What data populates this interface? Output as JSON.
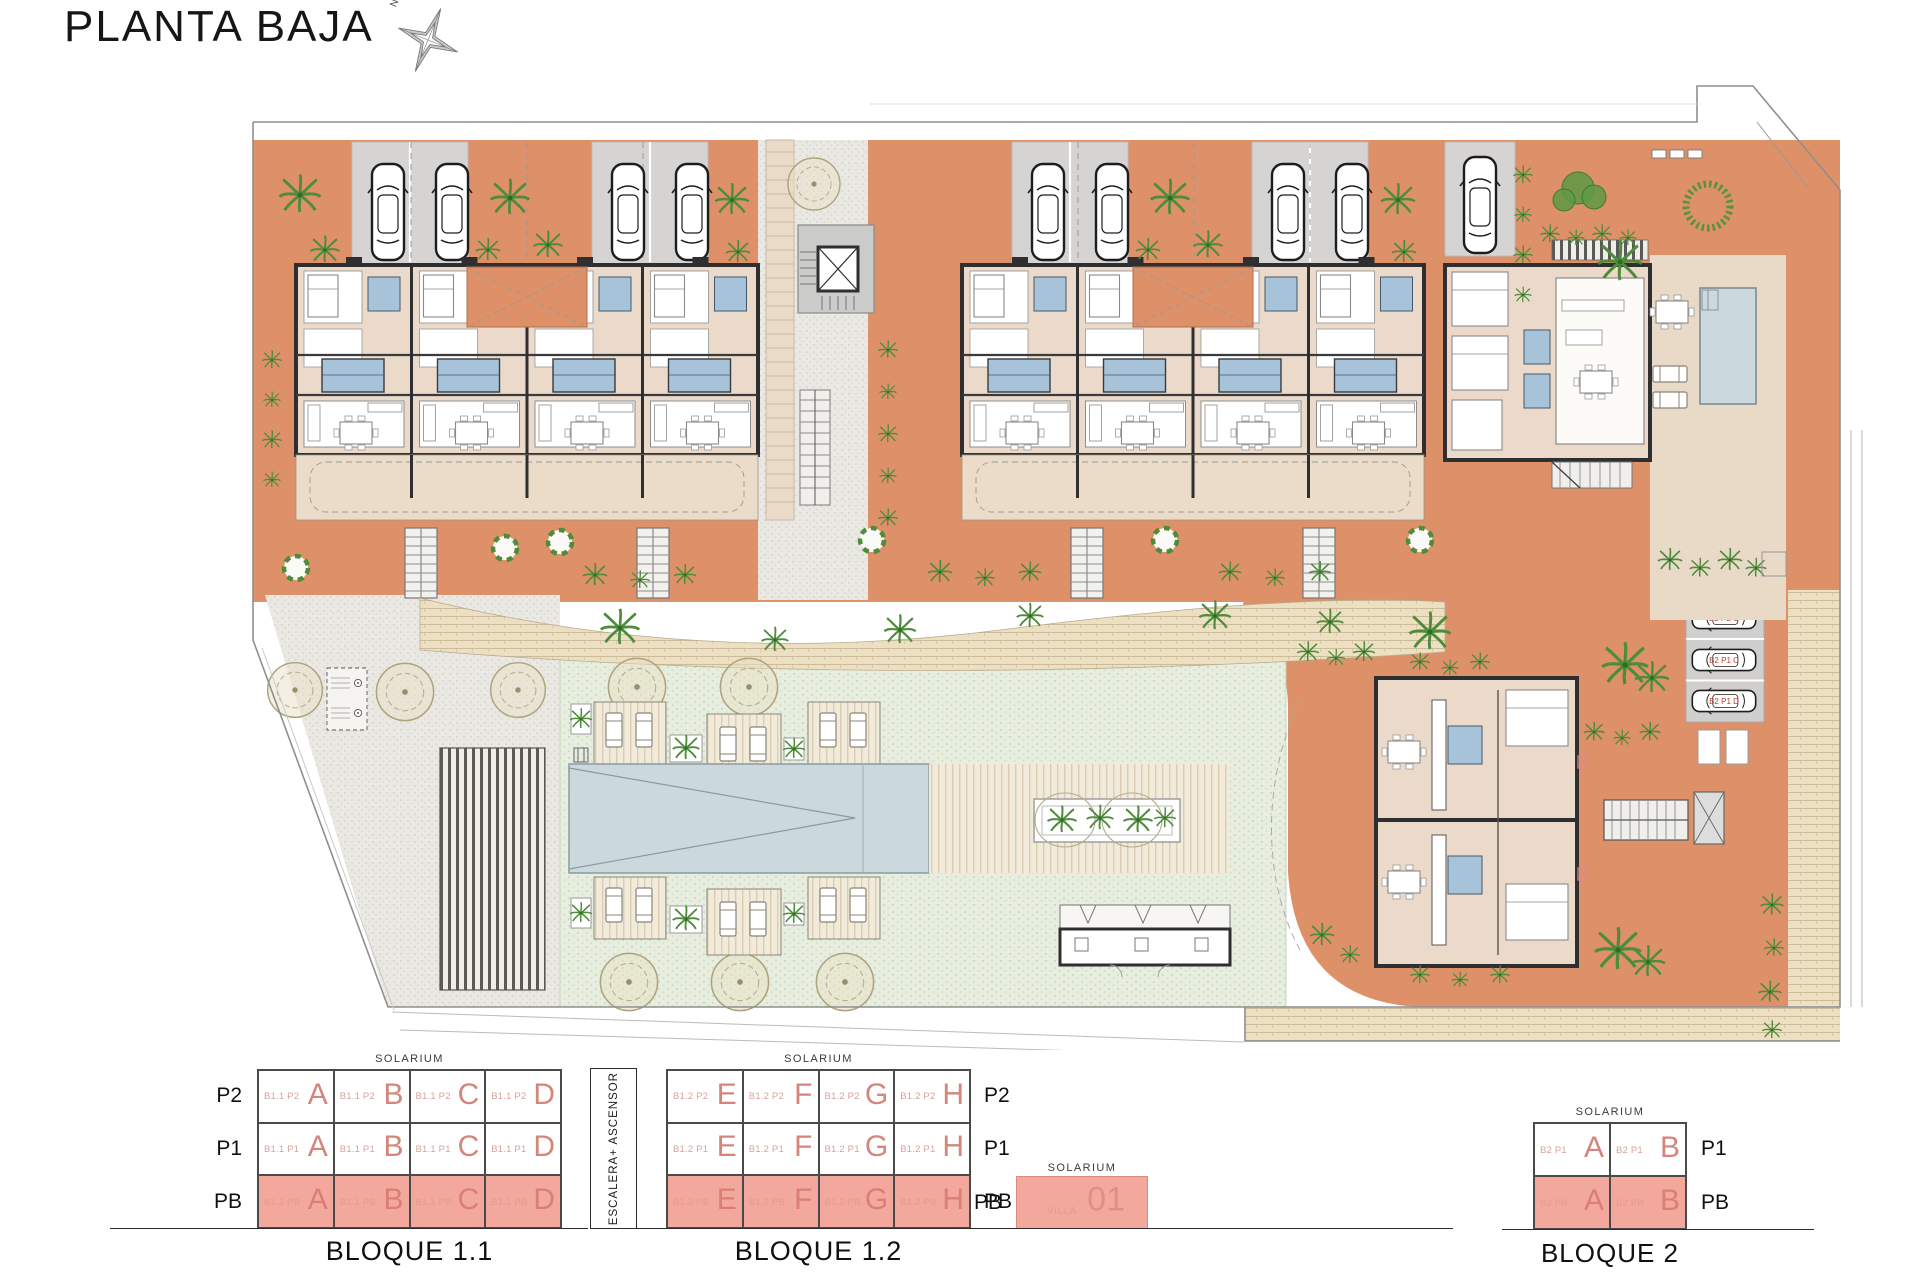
{
  "title": "PLANTA BAJA",
  "compass": {
    "label": "N"
  },
  "site_plan": {
    "parking_labels": [
      "B2 PB A",
      "B2 PB B",
      "B2 P1 C",
      "B2 P1 D"
    ]
  },
  "diagrams": {
    "escalera_label": "ESCALERA+ ASCENSOR",
    "bloque11": {
      "name": "BLOQUE 1.1",
      "solarium": "SOLARIUM",
      "floors": [
        "P2",
        "P1",
        "PB"
      ],
      "rows": [
        {
          "floor": "P2",
          "cells": [
            {
              "code": "B1.1 P2",
              "letter": "A"
            },
            {
              "code": "B1.1 P2",
              "letter": "B"
            },
            {
              "code": "B1.1 P2",
              "letter": "C"
            },
            {
              "code": "B1.1 P2",
              "letter": "D"
            }
          ]
        },
        {
          "floor": "P1",
          "cells": [
            {
              "code": "B1.1 P1",
              "letter": "A"
            },
            {
              "code": "B1.1 P1",
              "letter": "B"
            },
            {
              "code": "B1.1 P1",
              "letter": "C"
            },
            {
              "code": "B1.1 P1",
              "letter": "D"
            }
          ]
        },
        {
          "floor": "PB",
          "cells": [
            {
              "code": "B1.1 PB",
              "letter": "A"
            },
            {
              "code": "B1.1 PB",
              "letter": "B"
            },
            {
              "code": "B1.1 PB",
              "letter": "C"
            },
            {
              "code": "B1.1 PB",
              "letter": "D"
            }
          ]
        }
      ]
    },
    "bloque12": {
      "name": "BLOQUE 1.2",
      "solarium": "SOLARIUM",
      "floors": [
        "P2",
        "P1",
        "PB"
      ],
      "rows": [
        {
          "floor": "P2",
          "cells": [
            {
              "code": "B1.2 P2",
              "letter": "E"
            },
            {
              "code": "B1.2 P2",
              "letter": "F"
            },
            {
              "code": "B1.2 P2",
              "letter": "G"
            },
            {
              "code": "B1.2 P2",
              "letter": "H"
            }
          ]
        },
        {
          "floor": "P1",
          "cells": [
            {
              "code": "B1.2 P1",
              "letter": "E"
            },
            {
              "code": "B1.2 P1",
              "letter": "F"
            },
            {
              "code": "B1.2 P1",
              "letter": "G"
            },
            {
              "code": "B1.2 P1",
              "letter": "H"
            }
          ]
        },
        {
          "floor": "PB",
          "cells": [
            {
              "code": "B1.2 PB",
              "letter": "E"
            },
            {
              "code": "B1.2 PB",
              "letter": "F"
            },
            {
              "code": "B1.2 PB",
              "letter": "G"
            },
            {
              "code": "B1.2 PB",
              "letter": "H"
            }
          ]
        }
      ]
    },
    "villa": {
      "solarium": "SOLARIUM",
      "floor": "PB",
      "code": "VILLA",
      "letter": "01"
    },
    "bloque2": {
      "name": "BLOQUE 2",
      "solarium": "SOLARIUM",
      "floors": [
        "P1",
        "PB"
      ],
      "rows": [
        {
          "floor": "P1",
          "cells": [
            {
              "code": "B2 P1",
              "letter": "A"
            },
            {
              "code": "B2 P1",
              "letter": "B"
            }
          ]
        },
        {
          "floor": "PB",
          "cells": [
            {
              "code": "B2 PB",
              "letter": "A"
            },
            {
              "code": "B2 PB",
              "letter": "B"
            }
          ]
        }
      ]
    }
  },
  "colors": {
    "terracotta": "#DE9068",
    "beige_floor": "#EBDACA",
    "bath_blue": "#A7C3DA",
    "pb_highlight": "#F3A89E",
    "unit_letter": "#D4857C",
    "parking_label_red": "#C0392B",
    "pool": "#CBD9DE"
  }
}
